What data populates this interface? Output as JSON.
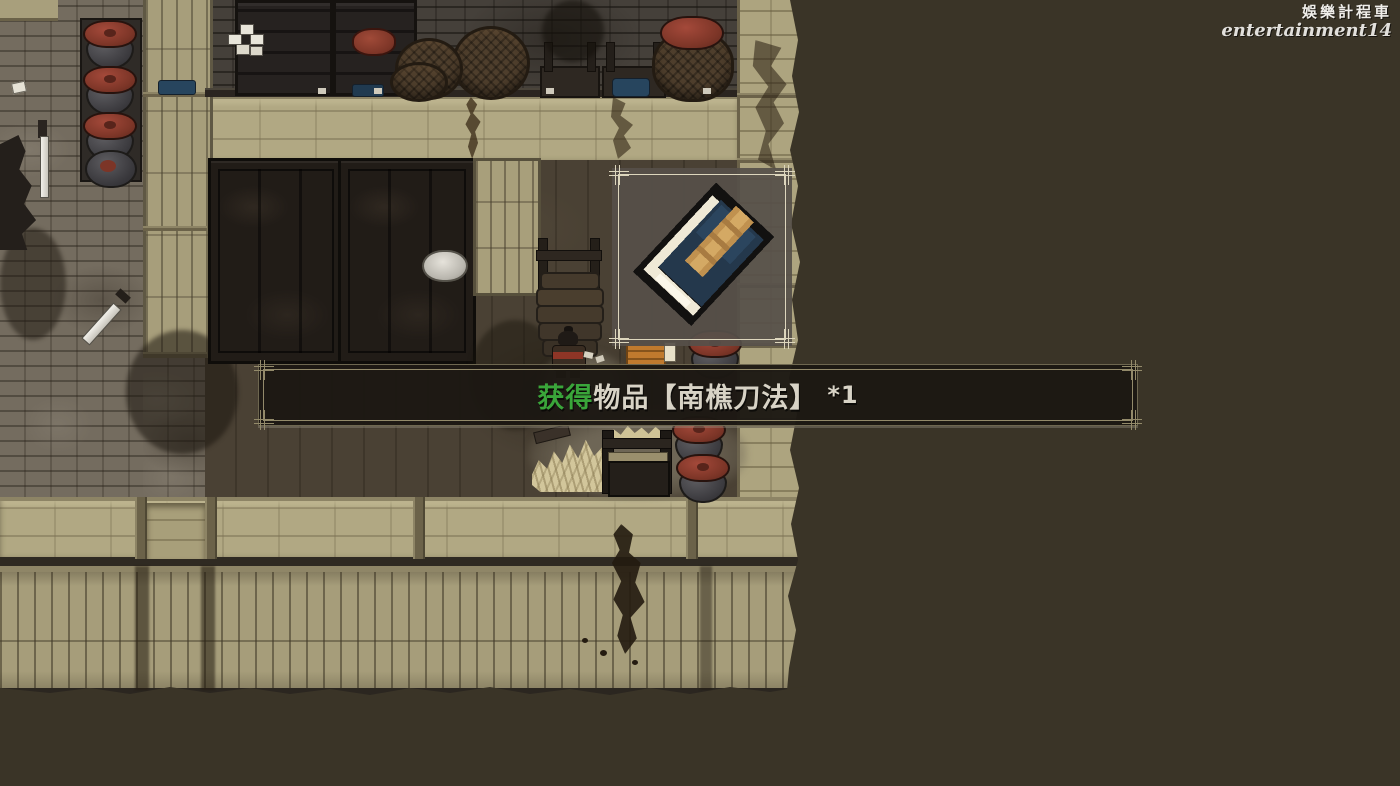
{
  "watermark": {
    "line1": "娛樂計程車",
    "line2": "entertainment14"
  },
  "banner": {
    "prefix": "获得",
    "body": "物品【南樵刀法】",
    "count": "*1"
  },
  "popup": {
    "item_icon": "blade-manual-book-icon",
    "item_name": "南樵刀法"
  },
  "colors": {
    "void": "#3a3427",
    "khaki_wall": "#b1a883",
    "cobble": "#746c5f",
    "banner_green": "#3aa53a",
    "banner_text": "#d8d3c6",
    "banner_bg": "#1c1813",
    "popup_border": "#ddd6bd",
    "jar_lid_red": "#8e3b2e",
    "book_cover": "#24384c",
    "book_strap": "#c0914f"
  }
}
